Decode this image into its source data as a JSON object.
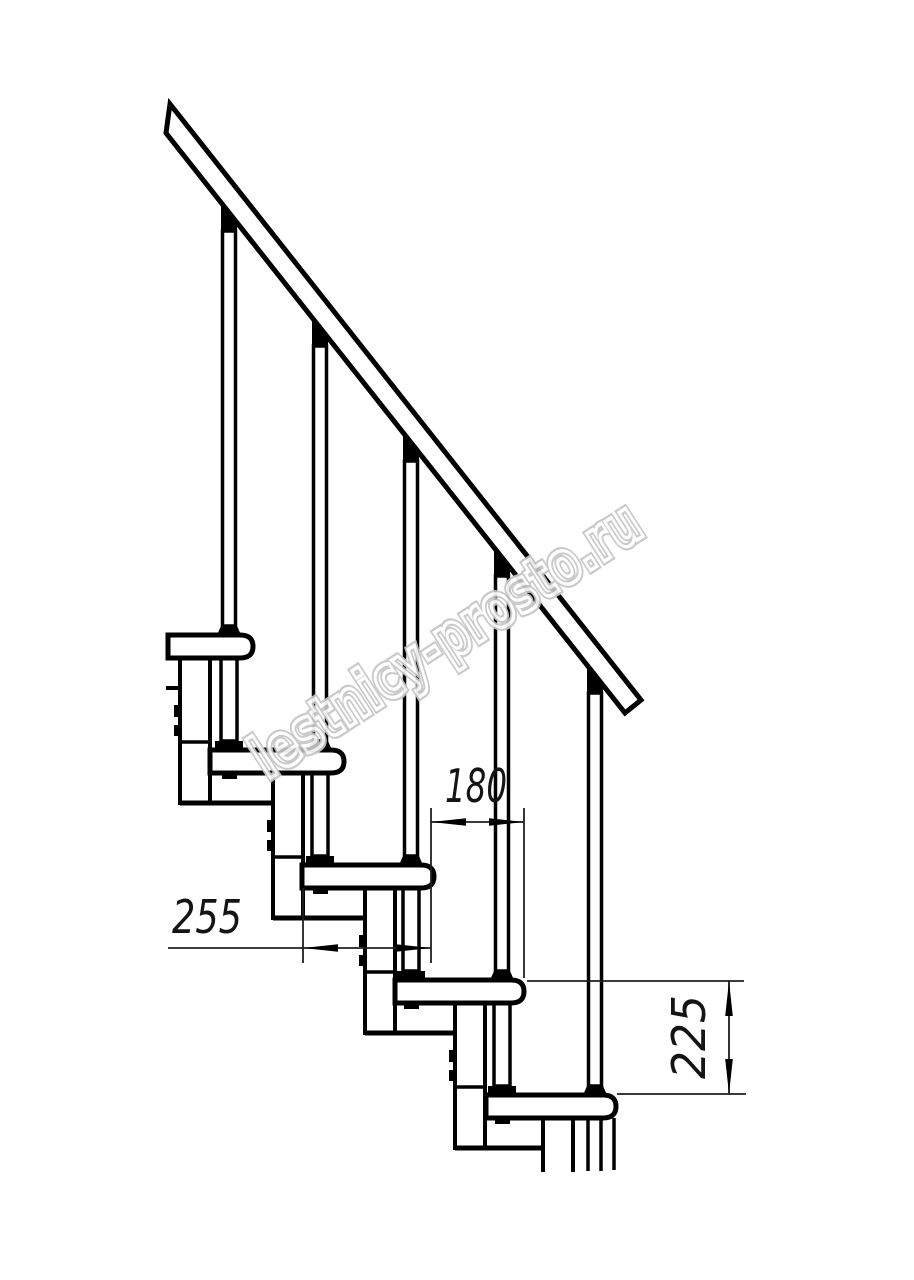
{
  "drawing": {
    "kind": "staircase-side-view-technical-drawing",
    "colors": {
      "line": "#000000",
      "dimension_text": "#141414",
      "watermark": "#c6c6c6",
      "background": "#ffffff"
    },
    "components": {
      "handrail": "handrail",
      "balusters_count": 5,
      "treads_count": 5,
      "support_modules_count": 5
    }
  },
  "dimensions": {
    "step_run": {
      "label": "180"
    },
    "tread_depth": {
      "label": "255"
    },
    "riser_height": {
      "label": "225"
    }
  },
  "watermark": {
    "text": "lestnicy-prosto.ru"
  }
}
